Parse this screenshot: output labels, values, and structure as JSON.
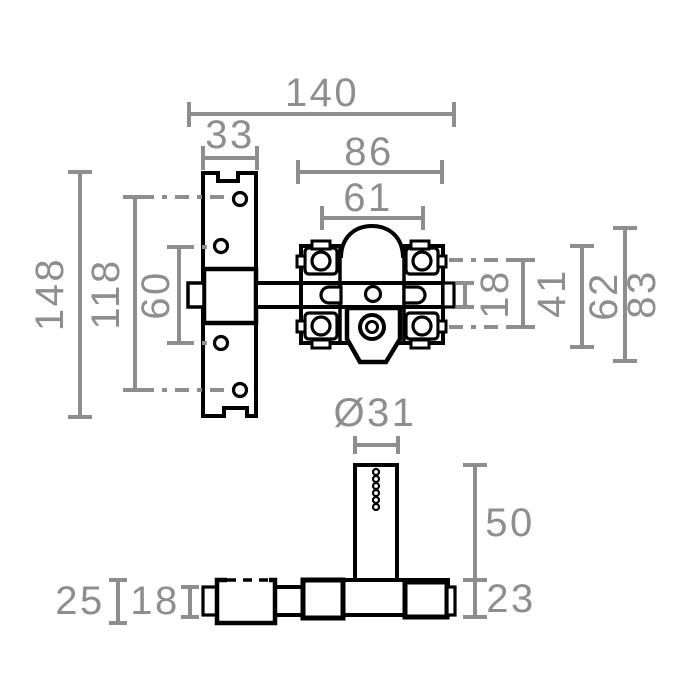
{
  "drawing_title": "lock-technical-drawing",
  "colors": {
    "outline": "#000000",
    "dimension": "#8e8e8e",
    "background": "#ffffff"
  },
  "front_view": {
    "labels": {
      "total_width": "140",
      "plate_width": "33",
      "body_width": "86",
      "screw_span_width": "61",
      "plate_height": "148",
      "outer_screw_span": "118",
      "inner_screw_span": "60",
      "bolt_height": "18",
      "body_screw_span": "41",
      "body_plate_height": "62",
      "body_total_height": "83"
    }
  },
  "side_view": {
    "labels": {
      "cylinder_diameter": "Ø31",
      "cylinder_height": "50",
      "base_thickness": "23",
      "keeper_thickness": "25",
      "bolt_thickness": "18"
    }
  }
}
